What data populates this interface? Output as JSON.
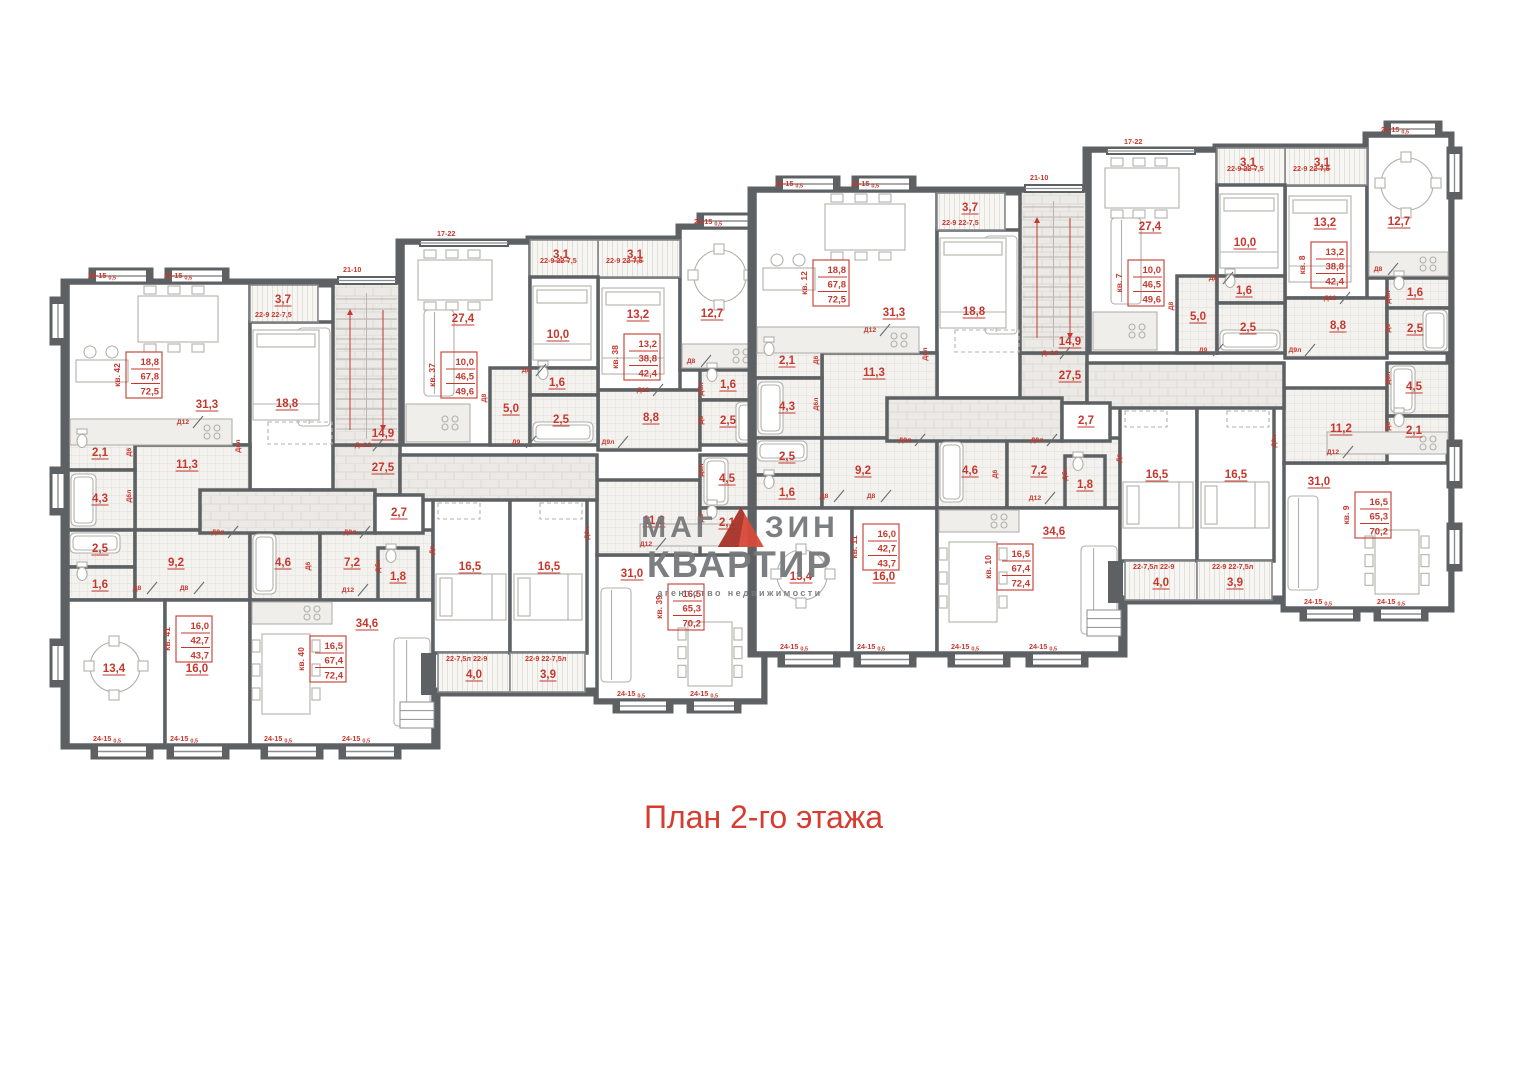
{
  "page": {
    "title": "План 2-го этажа"
  },
  "watermark": {
    "part1": "МАГ",
    "part2": "ЗИН",
    "line2": "КВАРТИР",
    "tagline": "агентство недвижимости"
  },
  "palette": {
    "wall": "#5d6163",
    "red": "#c5382e",
    "titleRed": "#d63c2f",
    "gray": "#76797b",
    "furn": "#b2b0ab",
    "winLine": "#8b8e90"
  },
  "plan": {
    "sections": [
      {
        "name": "left",
        "dx": 0,
        "dy": 0,
        "flats": [
          "кв. 42",
          "кв. 41",
          "кв. 40",
          "кв. 37",
          "кв. 38",
          "кв. 39"
        ],
        "side_bays": [
          [
            51,
            298,
            14,
            46
          ],
          [
            51,
            468,
            14,
            46
          ],
          [
            51,
            640,
            14,
            46
          ]
        ]
      },
      {
        "name": "right",
        "dx": 687,
        "dy": -92,
        "flats": [
          "кв. 12",
          "кв. 11",
          "кв. 10",
          "кв. 7",
          "кв. 8",
          "кв. 9"
        ],
        "side_bays": [
          [
            761,
            240,
            13,
            50
          ],
          [
            761,
            533,
            13,
            46
          ],
          [
            761,
            616,
            13,
            46
          ]
        ]
      }
    ],
    "outline": "M65,283 L400,283 L400,243 L530,243 L530,240 L680,240 L680,228 L763,228 L763,700 L598,700 L598,692 L436,692 L436,745 L65,745 Z",
    "rooms": [
      [
        68,
        283,
        182,
        162,
        "n",
        "31,3",
        207,
        408
      ],
      [
        250,
        322,
        85,
        168,
        "n",
        "18,8",
        287,
        407
      ],
      [
        250,
        285,
        68,
        37,
        "b",
        "3,7",
        283,
        303
      ],
      [
        135,
        445,
        115,
        85,
        "h",
        "11,3",
        187,
        468
      ],
      [
        68,
        432,
        67,
        38,
        "w",
        "2,1",
        100,
        456
      ],
      [
        68,
        470,
        67,
        60,
        "w",
        "4,3",
        100,
        502
      ],
      [
        68,
        530,
        67,
        37,
        "w",
        "2,5",
        100,
        552
      ],
      [
        68,
        567,
        67,
        33,
        "w",
        "1,6",
        100,
        588
      ],
      [
        135,
        530,
        115,
        70,
        "h",
        "9,2",
        176,
        566
      ],
      [
        68,
        600,
        97,
        145,
        "n",
        "13,4",
        114,
        672
      ],
      [
        165,
        600,
        85,
        145,
        "n",
        "16,0",
        197,
        672
      ],
      [
        250,
        530,
        70,
        70,
        "w",
        "4,6",
        283,
        566
      ],
      [
        320,
        530,
        113,
        70,
        "h",
        "7,2",
        352,
        566
      ],
      [
        378,
        548,
        40,
        52,
        "w",
        "1,8",
        398,
        580
      ],
      [
        250,
        600,
        183,
        145,
        "n",
        "34,6",
        367,
        627
      ],
      [
        433,
        498,
        77,
        155,
        "n",
        "16,5",
        470,
        570
      ],
      [
        438,
        653,
        72,
        39,
        "b",
        "4,0",
        474,
        678
      ],
      [
        510,
        498,
        77,
        155,
        "n",
        "16,5",
        549,
        570
      ],
      [
        510,
        653,
        75,
        39,
        "b",
        "3,9",
        548,
        678
      ],
      [
        597,
        555,
        166,
        145,
        "n",
        "31,0",
        632,
        577
      ],
      [
        597,
        480,
        103,
        75,
        "h",
        "11,2",
        654,
        524
      ],
      [
        700,
        455,
        63,
        53,
        "w",
        "4,5",
        727,
        482
      ],
      [
        700,
        508,
        63,
        35,
        "w",
        "2,1",
        727,
        526
      ],
      [
        598,
        277,
        82,
        113,
        "n",
        "13,2",
        638,
        318
      ],
      [
        680,
        228,
        83,
        142,
        "n",
        "12,7",
        712,
        317
      ],
      [
        598,
        390,
        102,
        60,
        "h",
        "8,8",
        651,
        421
      ],
      [
        700,
        370,
        63,
        30,
        "w",
        "1,6",
        728,
        388
      ],
      [
        700,
        400,
        63,
        45,
        "w",
        "2,5",
        728,
        424
      ],
      [
        598,
        240,
        82,
        37,
        "b",
        "3,1",
        635,
        258
      ],
      [
        403,
        243,
        127,
        202,
        "n",
        "27,4",
        463,
        322
      ],
      [
        530,
        240,
        68,
        37,
        "b",
        "3,1",
        561,
        258
      ],
      [
        530,
        277,
        68,
        91,
        "n",
        "10,0",
        558,
        338
      ],
      [
        490,
        368,
        40,
        77,
        "h",
        "5,0",
        511,
        412
      ],
      [
        530,
        368,
        68,
        27,
        "w",
        "1,6",
        557,
        386
      ],
      [
        530,
        395,
        68,
        50,
        "w",
        "2,5",
        561,
        423
      ],
      [
        333,
        445,
        67,
        50,
        "c",
        "27,5",
        383,
        471
      ],
      [
        200,
        490,
        175,
        43,
        "c",
        null,
        0,
        0
      ],
      [
        400,
        455,
        197,
        45,
        "c",
        null,
        0,
        0
      ],
      [
        375,
        495,
        48,
        38,
        "n",
        "2,7",
        399,
        516
      ]
    ],
    "stairs": {
      "x": 333,
      "y": 283,
      "w": 67,
      "h": 162,
      "label": "14,9",
      "lx": 383,
      "ly": 437
    },
    "apt_values": [
      [
        "18,8",
        "67,8",
        "72,5"
      ],
      [
        "16,0",
        "42,7",
        "43,7"
      ],
      [
        "16,5",
        "67,4",
        "72,4"
      ],
      [
        "10,0",
        "46,5",
        "49,6"
      ],
      [
        "13,2",
        "38,8",
        "42,4"
      ],
      [
        "16,5",
        "65,3",
        "70,2"
      ]
    ],
    "apt_boxes": [
      [
        0,
        126,
        352
      ],
      [
        1,
        176,
        616
      ],
      [
        2,
        310,
        636
      ],
      [
        3,
        441,
        352
      ],
      [
        4,
        624,
        334
      ],
      [
        5,
        668,
        584
      ]
    ],
    "doors": [
      [
        183,
        424,
        "Д12",
        0
      ],
      [
        240,
        446,
        "Двл",
        90
      ],
      [
        131,
        452,
        "Д6",
        90
      ],
      [
        131,
        496,
        "Д6л",
        90
      ],
      [
        137,
        590,
        "Д8",
        0
      ],
      [
        184,
        590,
        "Д8",
        0
      ],
      [
        218,
        534,
        "Д9л",
        0
      ],
      [
        350,
        534,
        "Д9л",
        0
      ],
      [
        310,
        566,
        "Д6",
        90
      ],
      [
        380,
        566,
        "Дбл",
        90
      ],
      [
        348,
        592,
        "Д12",
        0
      ],
      [
        526,
        372,
        "Д8",
        0
      ],
      [
        486,
        398,
        "Д8",
        90
      ],
      [
        516,
        444,
        "Д9",
        0
      ],
      [
        643,
        392,
        "Д12",
        0
      ],
      [
        691,
        363,
        "Д8",
        0
      ],
      [
        703,
        389,
        "Дбл",
        90
      ],
      [
        703,
        420,
        "Д6",
        90
      ],
      [
        646,
        546,
        "Д12",
        0
      ],
      [
        608,
        444,
        "Д9л",
        0
      ],
      [
        434,
        550,
        "Дв",
        90
      ],
      [
        589,
        533,
        "Д8л",
        90
      ],
      [
        363,
        447,
        "Дн12",
        0
      ],
      [
        703,
        470,
        "Д6л",
        90
      ],
      [
        703,
        518,
        "Д6",
        90
      ]
    ],
    "windows": [
      [
        88,
        278,
        "24-15",
        "0,5",
        0
      ],
      [
        164,
        278,
        "24-15",
        "0,5",
        0
      ],
      [
        343,
        272,
        "21-10",
        "",
        0
      ],
      [
        437,
        236,
        "17-22",
        "",
        0
      ],
      [
        540,
        263,
        "22-9  22-7,5",
        "",
        0
      ],
      [
        606,
        263,
        "22-9  22-7,5",
        "",
        0
      ],
      [
        694,
        224,
        "24-15",
        "0,5",
        0
      ],
      [
        255,
        317,
        "22-9  22-7,5",
        "",
        0
      ],
      [
        93,
        741,
        "24-15",
        "0,5",
        0
      ],
      [
        170,
        741,
        "24-15",
        "0,5",
        0
      ],
      [
        264,
        741,
        "24-15",
        "0,5",
        0
      ],
      [
        342,
        741,
        "24-15",
        "0,5",
        0
      ],
      [
        446,
        661,
        "22-7,5л  22-9",
        "",
        0
      ],
      [
        525,
        661,
        "22-9  22-7,5л",
        "",
        0
      ],
      [
        617,
        696,
        "24-15",
        "0,5",
        0
      ],
      [
        690,
        696,
        "24-15",
        "0,5",
        0
      ]
    ],
    "bays": [
      [
        90,
        269,
        62,
        14
      ],
      [
        166,
        269,
        62,
        14
      ],
      [
        698,
        214,
        56,
        14
      ],
      [
        92,
        745,
        60,
        13
      ],
      [
        168,
        745,
        60,
        13
      ],
      [
        262,
        745,
        60,
        13
      ],
      [
        340,
        745,
        60,
        13
      ],
      [
        614,
        700,
        58,
        12
      ],
      [
        688,
        700,
        52,
        12
      ]
    ],
    "flat_windows": [
      [
        338,
        277,
        58,
        7
      ],
      [
        420,
        240,
        88,
        6
      ]
    ],
    "porch": {
      "x": 400,
      "y": 702,
      "w": 34,
      "h": 26,
      "stub": [
        421,
        653,
        15,
        42
      ]
    },
    "furniture": [
      [
        "dtable",
        138,
        296,
        80,
        46
      ],
      [
        "bar",
        76,
        360,
        52,
        22
      ],
      [
        "counter",
        70,
        419,
        162,
        26
      ],
      [
        "sofa",
        298,
        328,
        32,
        98
      ],
      [
        "bed",
        253,
        330,
        66,
        90
      ],
      [
        "ward",
        268,
        422,
        64,
        22
      ],
      [
        "rtable",
        90,
        642,
        50,
        50
      ],
      [
        "counter",
        252,
        602,
        80,
        22
      ],
      [
        "dtable",
        262,
        634,
        48,
        80
      ],
      [
        "sofa",
        394,
        638,
        36,
        88
      ],
      [
        "bed2",
        436,
        574,
        70,
        46
      ],
      [
        "ward",
        438,
        503,
        42,
        16
      ],
      [
        "bed2",
        514,
        574,
        68,
        46
      ],
      [
        "ward",
        540,
        503,
        42,
        16
      ],
      [
        "counter",
        640,
        524,
        121,
        22
      ],
      [
        "sofa",
        601,
        588,
        30,
        94
      ],
      [
        "dtable",
        688,
        622,
        44,
        64
      ],
      [
        "bed",
        602,
        288,
        62,
        86
      ],
      [
        "rtable",
        694,
        250,
        52,
        52
      ],
      [
        "counter",
        682,
        344,
        79,
        24
      ],
      [
        "dtable",
        418,
        260,
        74,
        40
      ],
      [
        "sofa",
        424,
        310,
        30,
        86
      ],
      [
        "counter",
        406,
        404,
        64,
        38
      ],
      [
        "bed",
        533,
        286,
        58,
        74
      ],
      [
        "tub",
        71,
        474,
        25,
        52
      ],
      [
        "tub",
        70,
        533,
        50,
        20
      ],
      [
        "tub",
        253,
        534,
        23,
        60
      ],
      [
        "tub",
        736,
        402,
        24,
        41
      ],
      [
        "tub",
        704,
        458,
        24,
        47
      ],
      [
        "tub",
        533,
        422,
        60,
        20
      ],
      [
        "wc",
        82,
        441,
        0,
        0
      ],
      [
        "wc",
        82,
        574,
        0,
        0
      ],
      [
        "wc",
        712,
        512,
        0,
        0
      ],
      [
        "wc",
        712,
        375,
        0,
        0
      ],
      [
        "wc",
        543,
        373,
        0,
        0
      ],
      [
        "wc",
        391,
        556,
        0,
        0
      ]
    ]
  }
}
